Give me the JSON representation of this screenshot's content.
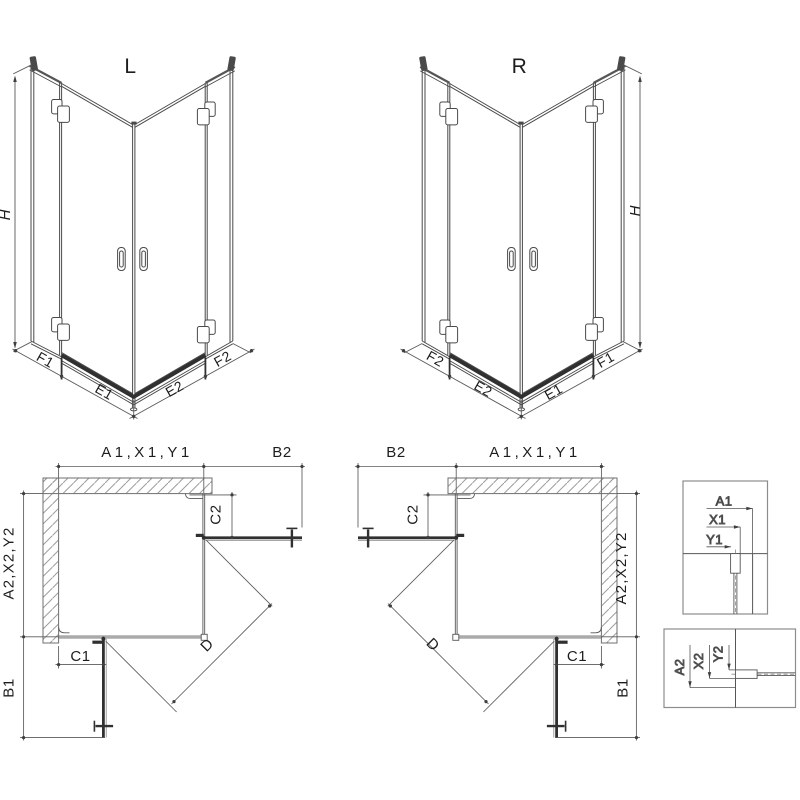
{
  "colors": {
    "background": "#ffffff",
    "line": "#4a4a4a",
    "dark_element": "#303030",
    "dimension_line": "#5a5a5a",
    "wall_hatch": "#9d9d9d",
    "text": "#1d1d1d"
  },
  "iso": {
    "left": {
      "title": "L",
      "height": "H",
      "segments": [
        "F1",
        "E1",
        "E2",
        "F2"
      ]
    },
    "right": {
      "title": "R",
      "height": "H",
      "segments": [
        "F2",
        "E2",
        "E1",
        "F1"
      ]
    }
  },
  "plan": {
    "left": {
      "top_width": "A1,X1,Y1",
      "door_width_top": "B2",
      "fixed_top": "C2",
      "side_width": "A2,X2,Y2",
      "door_width_side": "B1",
      "fixed_side": "C1",
      "diagonal": "D"
    },
    "right": {
      "door_width_top": "B2",
      "top_width": "A1,X1,Y1",
      "fixed_top": "C2",
      "side_width": "A2,X2,Y2",
      "door_width_side": "B1",
      "fixed_side": "C1",
      "diagonal": "D"
    }
  },
  "details": {
    "wall_profile_top": {
      "labels": [
        "A1",
        "X1",
        "Y1"
      ]
    },
    "wall_profile_side": {
      "labels": [
        "A2",
        "X2",
        "Y2"
      ]
    }
  }
}
